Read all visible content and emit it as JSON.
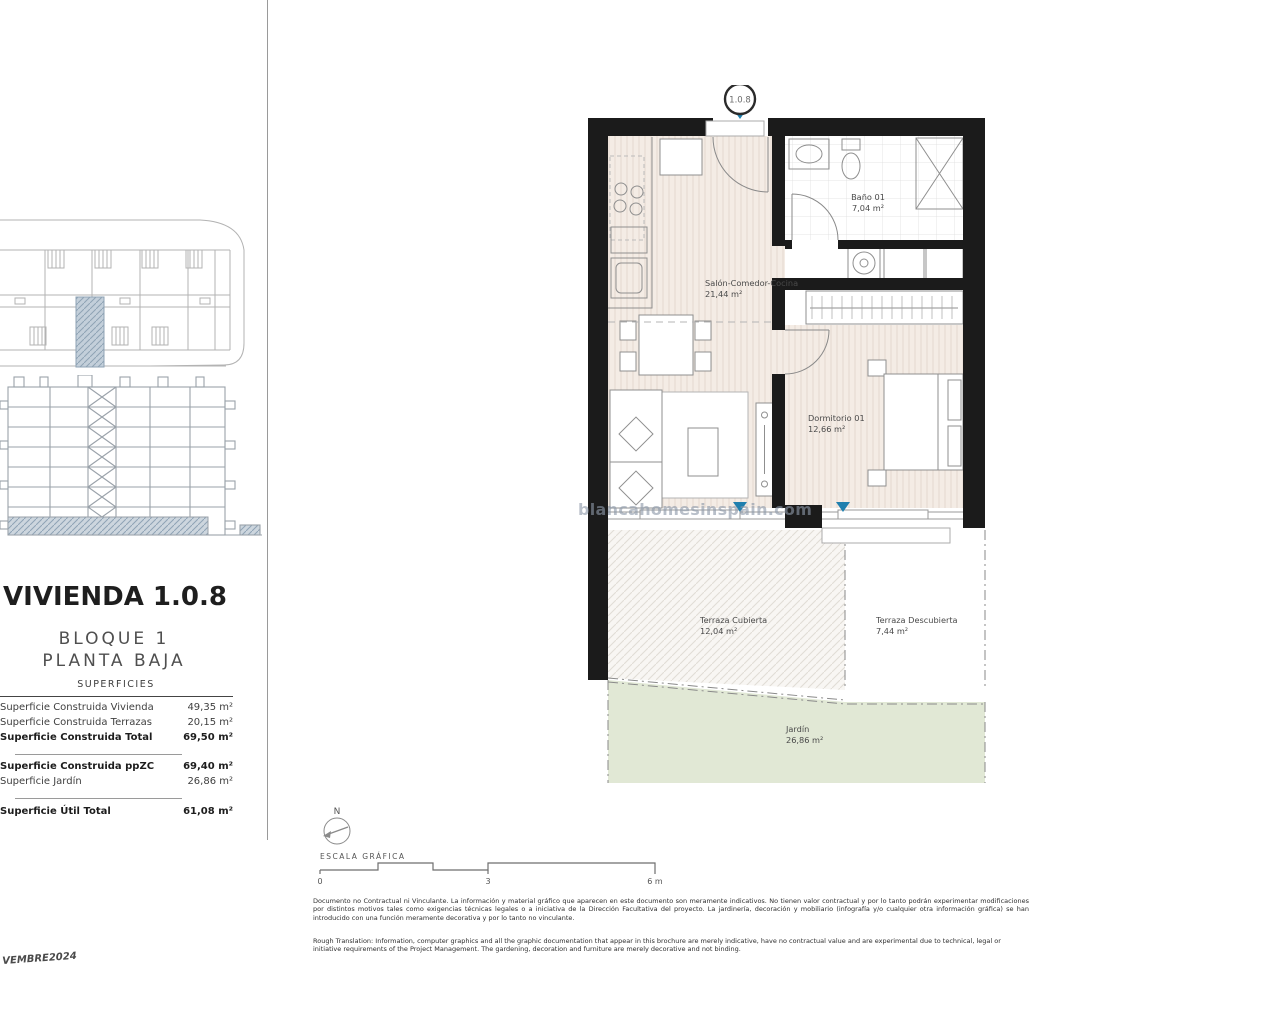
{
  "document": {
    "title": "VIVIENDA 1.0.8",
    "block": "BLOQUE 1",
    "floor": "PLANTA BAJA",
    "date_code": "VEMBRE2024",
    "watermark": "blancahomesinspain.com"
  },
  "surfaces": {
    "header": "SUPERFICIES",
    "rows": [
      {
        "label": "Superficie Construida Vivienda",
        "value": "49,35 m²"
      },
      {
        "label": "Superficie Construida Terrazas",
        "value": "20,15 m²"
      },
      {
        "label": "Superficie Construida Total",
        "value": "69,50 m²"
      },
      {
        "label": "Superficie Construida ppZC",
        "value": "69,40 m²"
      },
      {
        "label": "Superficie Jardín",
        "value": "26,86 m²"
      },
      {
        "label": "Superficie Útil Total",
        "value": "61,08 m²"
      }
    ]
  },
  "plan": {
    "unit_circle_label": "1.0.8",
    "rooms": {
      "salon": {
        "name": "Salón-Comedor-Cocina",
        "area": "21,44 m²"
      },
      "bano": {
        "name": "Baño 01",
        "area": "7,04 m²"
      },
      "dormitorio": {
        "name": "Dormitorio 01",
        "area": "12,66 m²"
      },
      "terraza_cubierta": {
        "name": "Terraza Cubierta",
        "area": "12,04 m²"
      },
      "terraza_descubierta": {
        "name": "Terraza Descubierta",
        "area": "7,44 m²"
      },
      "jardin": {
        "name": "Jardín",
        "area": "26,86 m²"
      }
    }
  },
  "scale_bar": {
    "north_label": "N",
    "label": "ESCALA GRÁFICA",
    "tick_0": "0",
    "tick_3": "3",
    "tick_6": "6 m"
  },
  "disclaimer": {
    "spanish": "Documento no Contractual ni Vinculante. La información y material gráfico que aparecen en este documento son meramente indicativos. No tienen valor contractual y por lo tanto podrán experimentar modificaciones por distintos motivos tales como exigencias técnicas legales o a iniciativa de la Dirección Facultativa del proyecto. La jardinería, decoración y mobiliario (infografía y/o cualquier otra información gráfica) se han introducido con una función meramente decorativa y por lo tanto no vinculante.",
    "english": "Rough Translation: Information, computer graphics and all the graphic documentation that appear in this brochure are merely indicative, have no contractual value and are experimental due to technical, legal or initiative requirements of the Project Management. The gardening, decoration and furniture are merely decorative and not binding."
  },
  "colors": {
    "wall": "#1b1b1b",
    "floor": "#f4ece5",
    "garden": "#e1e8d5",
    "marker_blue": "#1f7fae",
    "highlight_hatch": "#a9bccb"
  }
}
